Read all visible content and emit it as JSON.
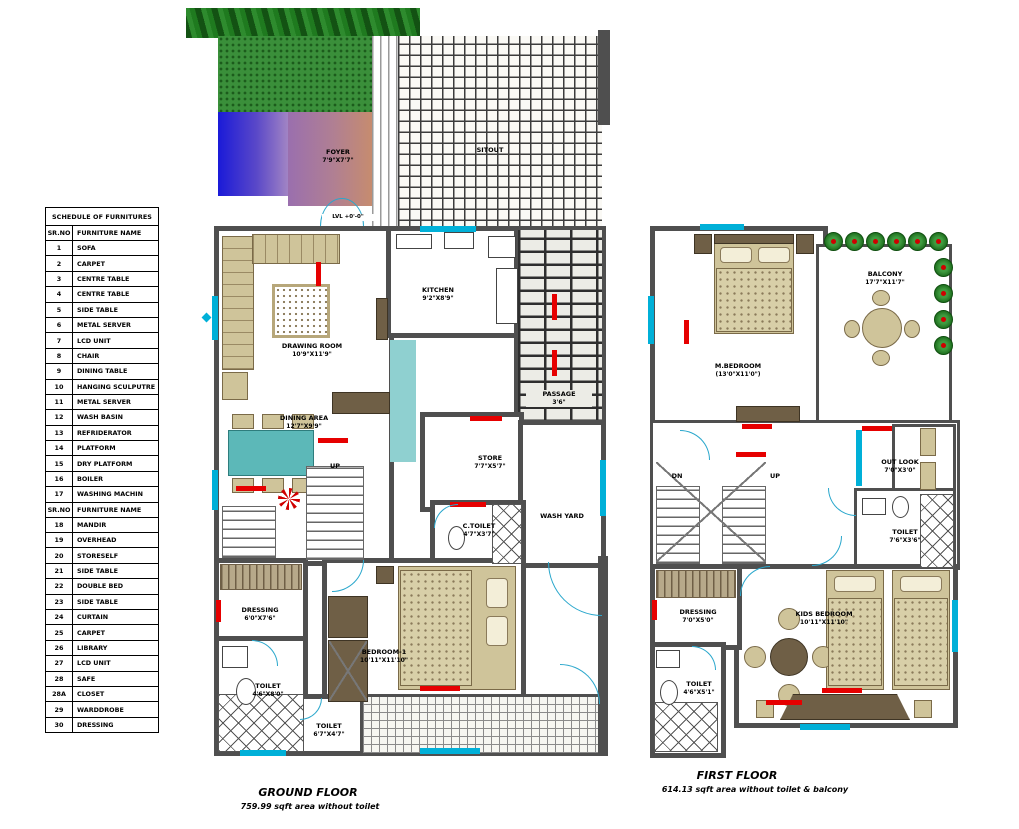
{
  "schedule": {
    "title": "SCHEDULE OF FURNITURES",
    "col_sr": "SR.NO",
    "col_name": "FURNITURE NAME",
    "rows1": [
      [
        "1",
        "SOFA"
      ],
      [
        "2",
        "CARPET"
      ],
      [
        "3",
        "CENTRE TABLE"
      ],
      [
        "4",
        "CENTRE TABLE"
      ],
      [
        "5",
        "SIDE TABLE"
      ],
      [
        "6",
        "METAL SERVER"
      ],
      [
        "7",
        "LCD UNIT"
      ],
      [
        "8",
        "CHAIR"
      ],
      [
        "9",
        "DINING TABLE"
      ],
      [
        "10",
        "HANGING SCULPUTRE"
      ],
      [
        "11",
        "METAL SERVER"
      ],
      [
        "12",
        "WASH BASIN"
      ],
      [
        "13",
        "REFRIDERATOR"
      ],
      [
        "14",
        "PLATFORM"
      ],
      [
        "15",
        "DRY PLATFORM"
      ],
      [
        "16",
        "BOILER"
      ],
      [
        "17",
        "WASHING MACHIN"
      ]
    ],
    "rows2": [
      [
        "18",
        "MANDIR"
      ],
      [
        "19",
        "OVERHEAD"
      ],
      [
        "20",
        "STORESELF"
      ],
      [
        "21",
        "SIDE TABLE"
      ],
      [
        "22",
        "DOUBLE BED"
      ],
      [
        "23",
        "SIDE TABLE"
      ],
      [
        "24",
        "CURTAIN"
      ],
      [
        "25",
        "CARPET"
      ],
      [
        "26",
        "LIBRARY"
      ],
      [
        "27",
        "LCD UNIT"
      ],
      [
        "28",
        "SAFE"
      ],
      [
        "28A",
        "CLOSET"
      ],
      [
        "29",
        "WARDDROBE"
      ],
      [
        "30",
        "DRESSING"
      ]
    ]
  },
  "ground_floor": {
    "title": "GROUND FLOOR",
    "area": "759.99 sqft area without toilet",
    "rooms": {
      "foyer": {
        "name": "FOYER",
        "dims": "7'9\"X7'7\""
      },
      "sitout": {
        "name": "SITOUT",
        "dims": ""
      },
      "lvl": {
        "name": "LVL +0'-0\"",
        "dims": ""
      },
      "drawing": {
        "name": "DRAWING ROOM",
        "dims": "10'9\"X11'9\""
      },
      "kitchen": {
        "name": "KITCHEN",
        "dims": "9'2\"X8'9\""
      },
      "dining": {
        "name": "DINING AREA",
        "dims": "12'7\"X9'9\""
      },
      "store": {
        "name": "STORE",
        "dims": "7'7\"X5'7\""
      },
      "passage": {
        "name": "PASSAGE",
        "dims": "3'6\""
      },
      "wash_yard": {
        "name": "WASH YARD",
        "dims": ""
      },
      "c_toilet": {
        "name": "C.TOILET",
        "dims": "4'7\"X3'7\""
      },
      "bedroom1": {
        "name": "BEDROOM-1",
        "dims": "10'11\"X11'10\""
      },
      "dressing": {
        "name": "DRESSING",
        "dims": "6'0\"X7'6\""
      },
      "toilet_side": {
        "name": "TOILET",
        "dims": "4'6\"X8'0\""
      },
      "toilet_common": {
        "name": "TOILET",
        "dims": "6'7\"X4'7\""
      },
      "up": "UP"
    }
  },
  "first_floor": {
    "title": "FIRST FLOOR",
    "area": "614.13 sqft area without toilet & balcony",
    "rooms": {
      "master": {
        "name": "M.BEDROOM",
        "dims": "(13'0\"X11'0\")"
      },
      "balcony": {
        "name": "BALCONY",
        "dims": "17'7\"X11'7\""
      },
      "outlook": {
        "name": "OUT LOOK",
        "dims": "7'0\"X3'0\""
      },
      "toilet_master": {
        "name": "TOILET",
        "dims": "7'6\"X3'6\""
      },
      "kids": {
        "name": "KIDS BEDROOM",
        "dims": "10'11\"X11'10\""
      },
      "dressing": {
        "name": "DRESSING",
        "dims": "7'0\"X5'0\""
      },
      "toilet_kids": {
        "name": "TOILET",
        "dims": "4'6\"X5'1\""
      },
      "dn": "DN",
      "up": "UP"
    }
  },
  "colors": {
    "wall": "#4f4f4f",
    "accent_cyan": "#00b0d8",
    "accent_red": "#e60000",
    "furniture_tan": "#cfc49a",
    "furniture_brown": "#6f5f46",
    "table_teal": "#5cb8b8",
    "garden_green": "#3a8f3a"
  }
}
